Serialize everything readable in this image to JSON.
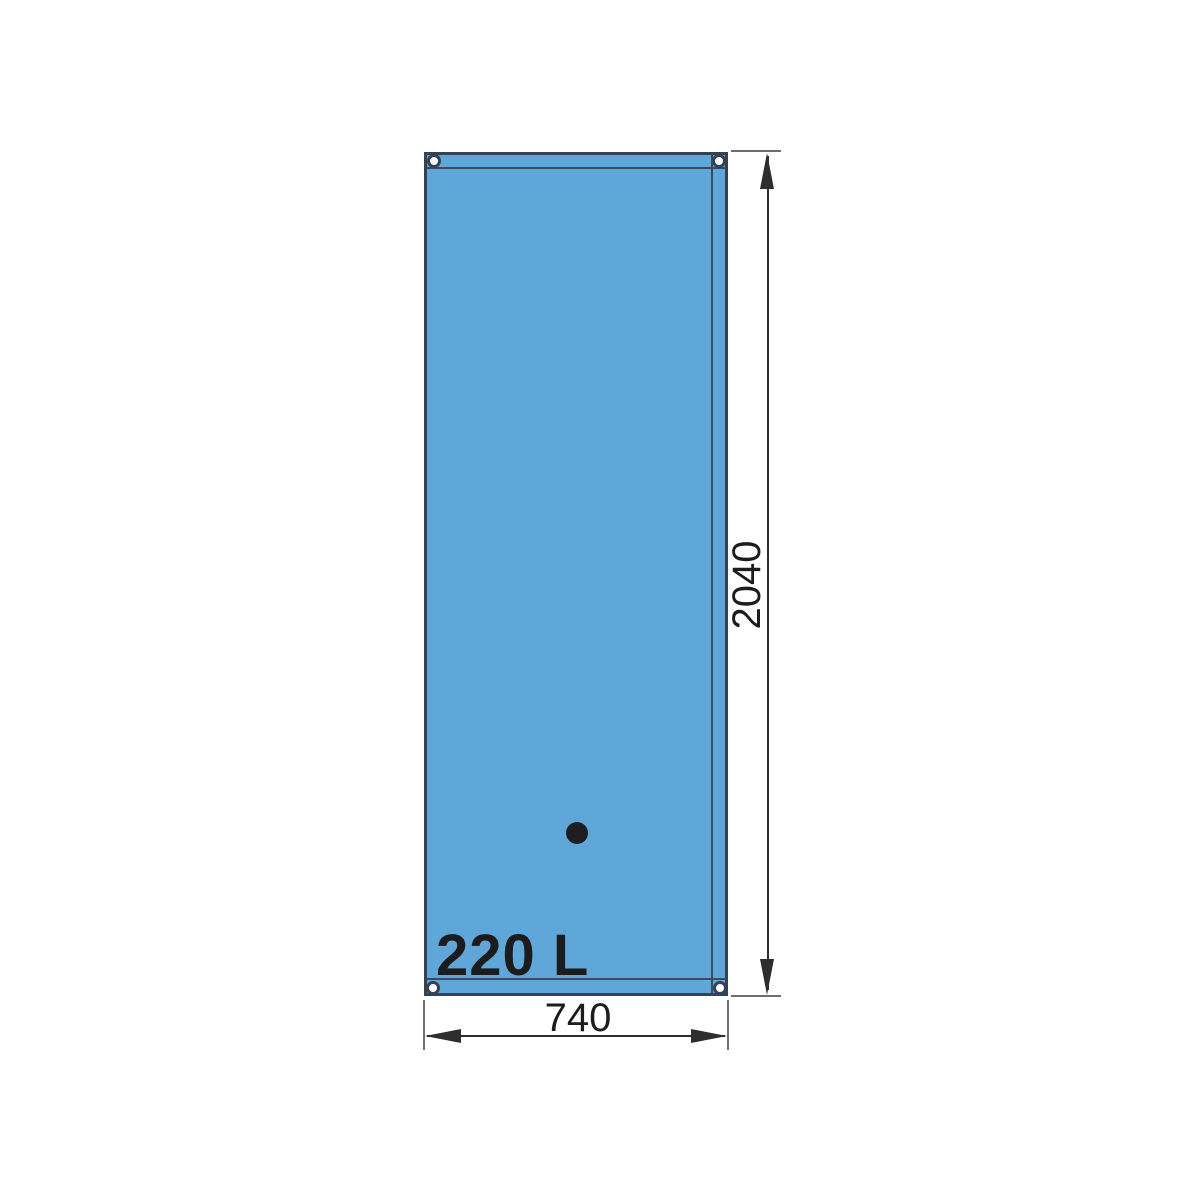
{
  "diagram": {
    "capacity_label": "220 L",
    "height_dimension": "2040",
    "width_dimension": "740"
  },
  "colors": {
    "background": "#ffffff",
    "tank-fill": "#60a7d9",
    "tank-outline": "#364254",
    "dim-line": "#2e2e2e",
    "ext-line": "#6e6e6e",
    "label-text": "#1c1c1c",
    "grommet-fill": "#ffffff",
    "port-dot": "#1e1e22"
  }
}
